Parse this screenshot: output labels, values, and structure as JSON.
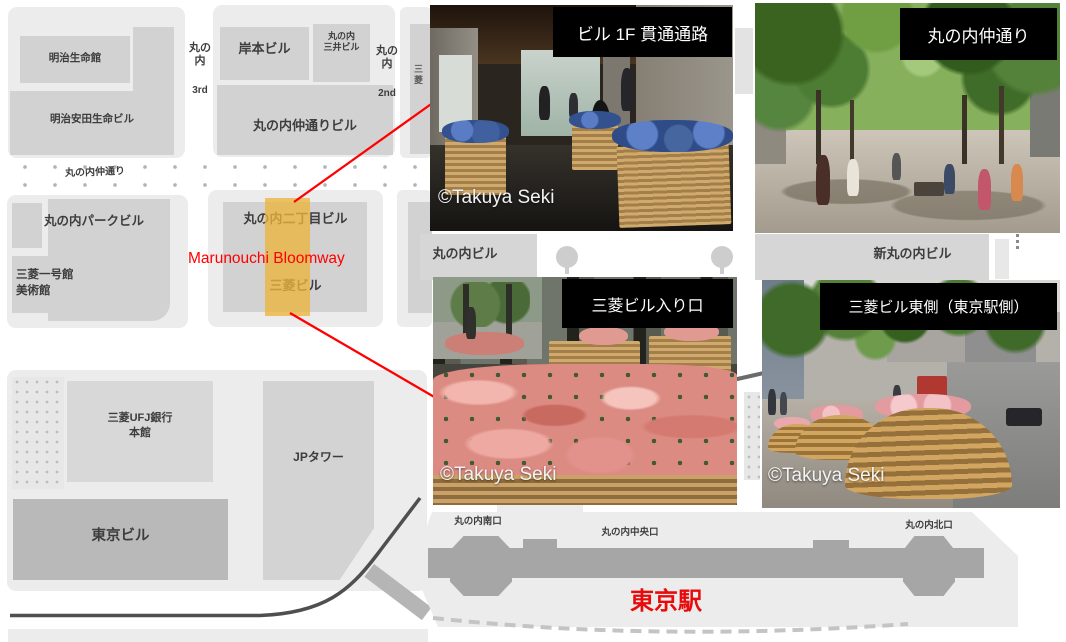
{
  "map": {
    "blocks": {
      "meiji_seimei": "明治生命館",
      "meiji_yasuda": "明治安田生命ビル",
      "kishimoto": "岸本ビル",
      "mitsui_l1": "丸の内",
      "mitsui_l2": "三井ビル",
      "nakadori_bldg": "丸の内仲通りビル",
      "partial_right": "三菱",
      "park_bldg": "丸の内パークビル",
      "ichigokan_l1": "三菱一号館",
      "ichigokan_l2": "美術館",
      "nichome_bldg": "丸の内二丁目ビル",
      "mitsubishi_bldg": "三菱ビル",
      "marunouchi_bldg": "丸の内ビル",
      "shin_marunouchi_bldg": "新丸の内ビル",
      "ufj_l1": "三菱UFJ銀行",
      "ufj_l2": "本館",
      "jp_tower": "JPタワー",
      "tokyo_bldg": "東京ビル"
    },
    "streets": {
      "third_kanji": "丸の内",
      "third_num": "3rd",
      "second_kanji": "丸の内",
      "second_num": "2nd",
      "nakadori": "丸の内仲通り"
    },
    "station": {
      "south_exit": "丸の内南口",
      "central_exit": "丸の内中央口",
      "north_exit": "丸の内北口",
      "name": "東京駅"
    },
    "annotation": {
      "bloomway": "Marunouchi Bloomway"
    }
  },
  "photos": [
    {
      "label": "ビル 1F 貫通通路",
      "credit": "©Takuya Seki"
    },
    {
      "label": "丸の内仲通り",
      "credit": ""
    },
    {
      "label": "三菱ビル入り口",
      "credit": "©Takuya Seki"
    },
    {
      "label": "三菱ビル東側（東京駅側）",
      "credit": "©Takuya Seki"
    }
  ],
  "colors": {
    "highlight": "#e9b23e",
    "accent_red": "#ff0000",
    "station_name_red": "#e80b0b"
  }
}
